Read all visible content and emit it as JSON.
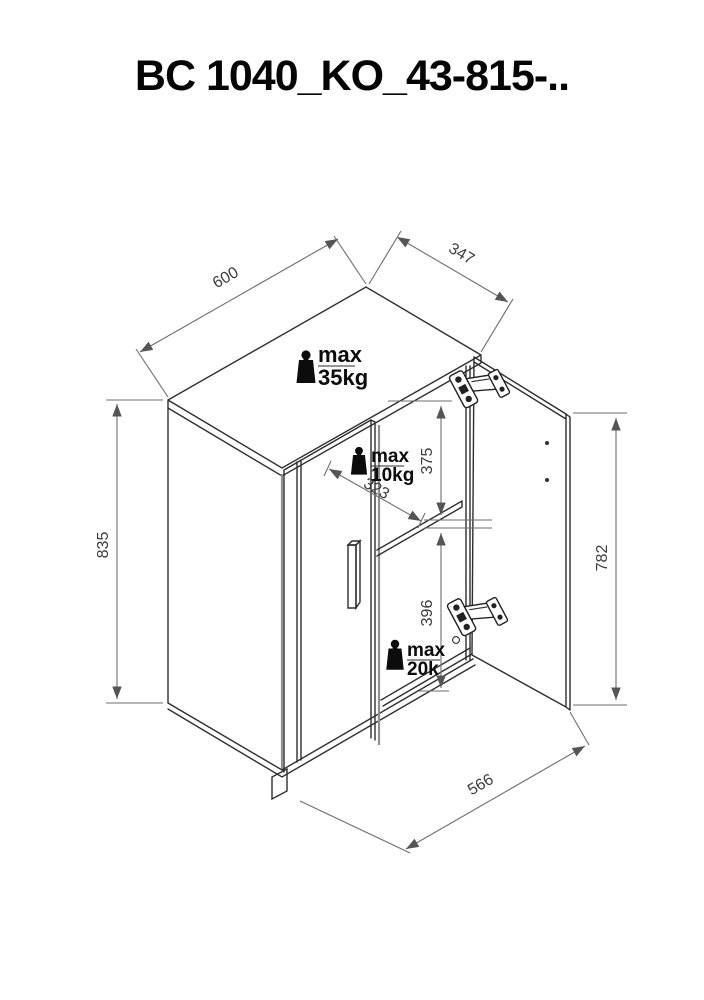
{
  "title": "BC 1040_KO_43-815-..",
  "colors": {
    "line": "#2e2e2e",
    "panel_edge": "#909090",
    "dimension": "#6e6e6e",
    "text": "#0c0c0c"
  },
  "drawing": {
    "dimensions": {
      "top_width": "600",
      "top_depth": "347",
      "left_height": "835",
      "door_height": "782",
      "bottom_width": "566",
      "shelf_clearance": "375",
      "shelf_depth": "323",
      "bottom_clearance": "396"
    },
    "load_labels": {
      "top": {
        "label": "max",
        "value": "35kg"
      },
      "shelf": {
        "label": "max",
        "value": "10kg"
      },
      "bottom": {
        "label": "max",
        "value": "20k"
      }
    }
  }
}
